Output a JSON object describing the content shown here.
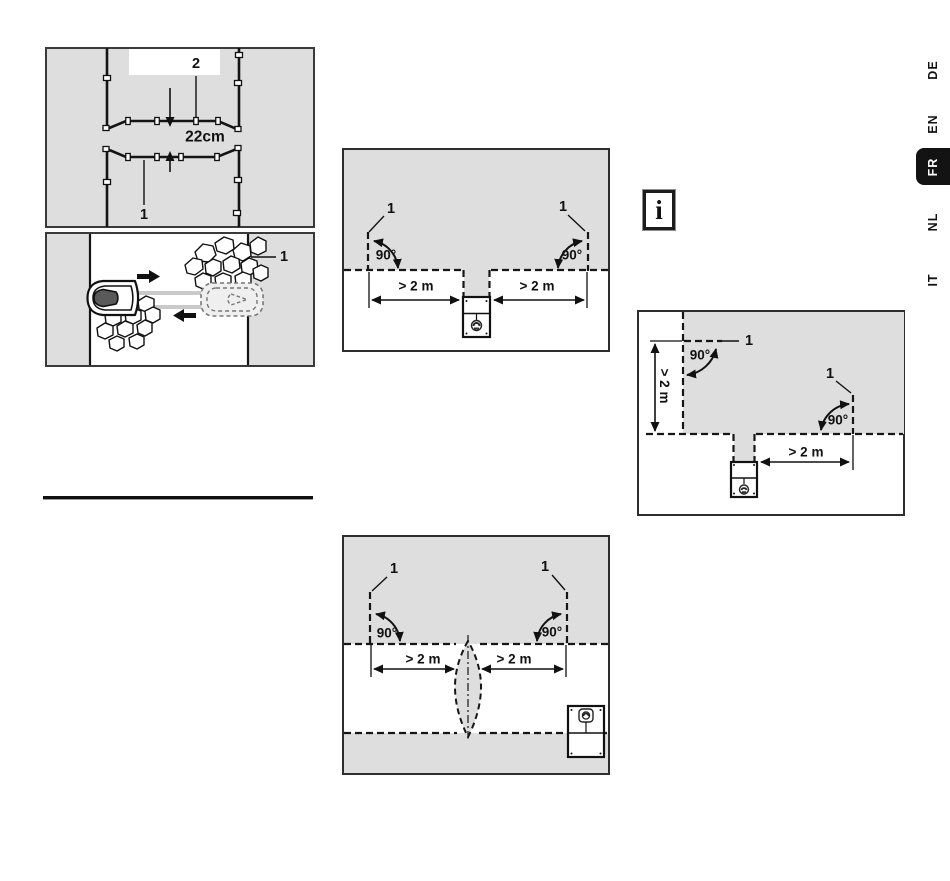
{
  "page": {
    "type": "manual-diagram-page",
    "background": "#ffffff"
  },
  "colors": {
    "figure_bg": "#dedede",
    "line": "#161616",
    "active_tab_bg": "#131313",
    "active_tab_text": "#ffffff",
    "corridor_bar": "#c9c9c9"
  },
  "sidebar_tabs": {
    "items": [
      {
        "label": "DE",
        "active": false
      },
      {
        "label": "EN",
        "active": false
      },
      {
        "label": "FR",
        "active": true
      },
      {
        "label": "NL",
        "active": false
      },
      {
        "label": "IT",
        "active": false
      }
    ]
  },
  "info_box": {
    "glyph": "i"
  },
  "figures": {
    "fig1": {
      "label_2": "2",
      "gap": "22cm",
      "one_top": "1",
      "one_bottom": "1"
    },
    "fig2": {
      "one_left": "1",
      "one_right": "1",
      "angle_left": "90°",
      "angle_right": "90°",
      "dist_left": "> 2 m",
      "dist_right": "> 2 m"
    },
    "fig3": {
      "one_top": "1",
      "one_right": "1",
      "angle_top": "90°",
      "angle_right": "90°",
      "dist_vertical": "> 2 m",
      "dist_horizontal": "> 2 m"
    },
    "fig4": {
      "one_left": "1",
      "one_right": "1",
      "angle_left": "90°",
      "angle_right": "90°",
      "dist_left": "> 2 m",
      "dist_right": "> 2 m"
    }
  }
}
